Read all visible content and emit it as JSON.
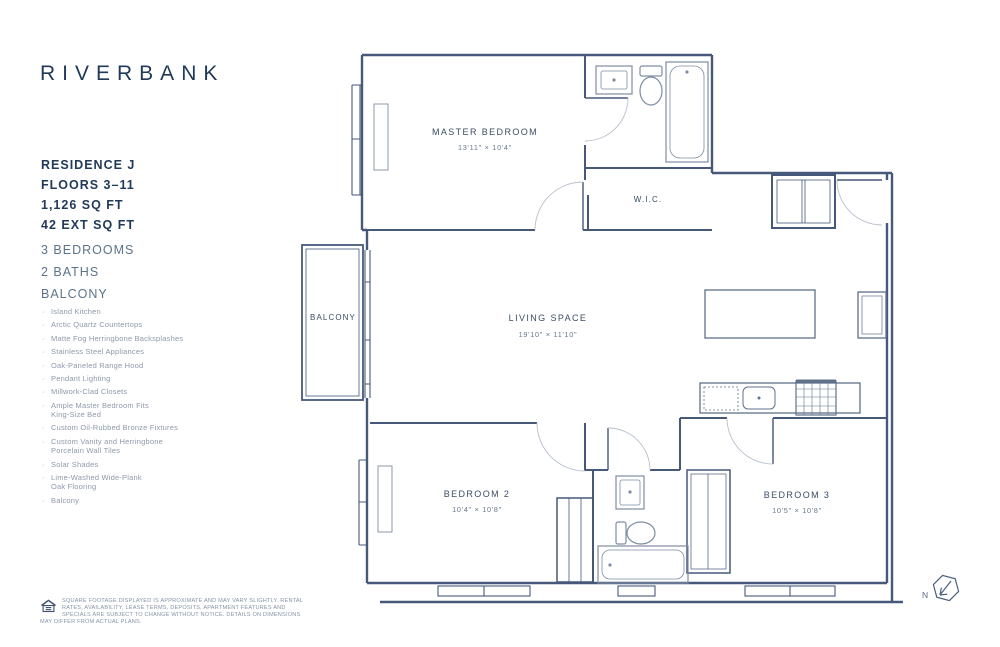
{
  "brand": {
    "logo": "RIVERBANK"
  },
  "unit": {
    "residence": "RESIDENCE J",
    "floors": "FLOORS 3–11",
    "area": "1,126 SQ FT",
    "ext_area": "42 EXT SQ FT",
    "summary": [
      "3 BEDROOMS",
      "2 BATHS",
      "BALCONY"
    ]
  },
  "features": [
    "Island Kitchen",
    "Arctic Quartz Countertops",
    "Matte Fog Herringbone Backsplashes",
    "Stainless Steel Appliances",
    "Oak-Paneled Range Hood",
    "Pendant Lighting",
    "Millwork-Clad Closets",
    "Ample Master Bedroom Fits\nKing-Size Bed",
    "Custom Oil-Rubbed Bronze Fixtures",
    "Custom Vanity and Herringbone\nPorcelain Wall Tiles",
    "Solar Shades",
    "Lime-Washed Wide-Plank\nOak Flooring",
    "Balcony"
  ],
  "rooms": {
    "master": {
      "name": "MASTER BEDROOM",
      "dims": "13'11\" × 10'4\""
    },
    "wic": {
      "name": "W.I.C."
    },
    "balcony": {
      "name": "BALCONY"
    },
    "living": {
      "name": "LIVING SPACE",
      "dims": "19'10\" × 11'10\""
    },
    "bedroom2": {
      "name": "BEDROOM 2",
      "dims": "10'4\" × 10'8\""
    },
    "bedroom3": {
      "name": "BEDROOM 3",
      "dims": "10'5\" × 10'8\""
    }
  },
  "compass": {
    "label": "N"
  },
  "disclaimer": "Square footage displayed is approximate and may vary slightly. Rental rates, availability, lease terms, deposits, apartment features and specials are subject to change without notice. Details on dimensions may differ from actual plans.",
  "colors": {
    "navy": "#223a5a",
    "wall": "#46597a",
    "muted": "#8d99ab"
  }
}
